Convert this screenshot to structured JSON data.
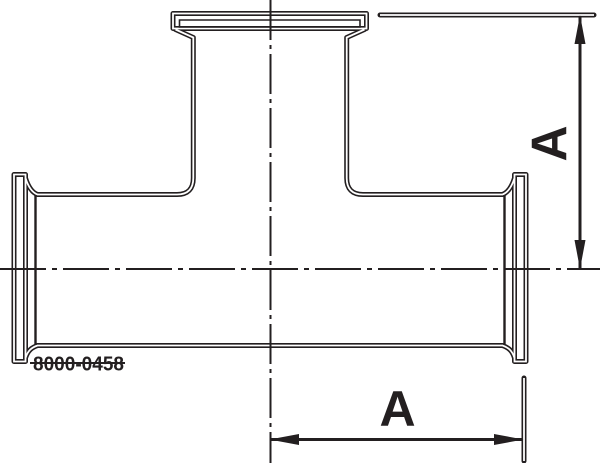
{
  "drawing": {
    "type": "tee-fitting-side-view",
    "part_number": "8000-0458",
    "dim_right_label": "A",
    "dim_bottom_label": "A",
    "line_color": "#231f20",
    "background_color": "#ffffff"
  }
}
